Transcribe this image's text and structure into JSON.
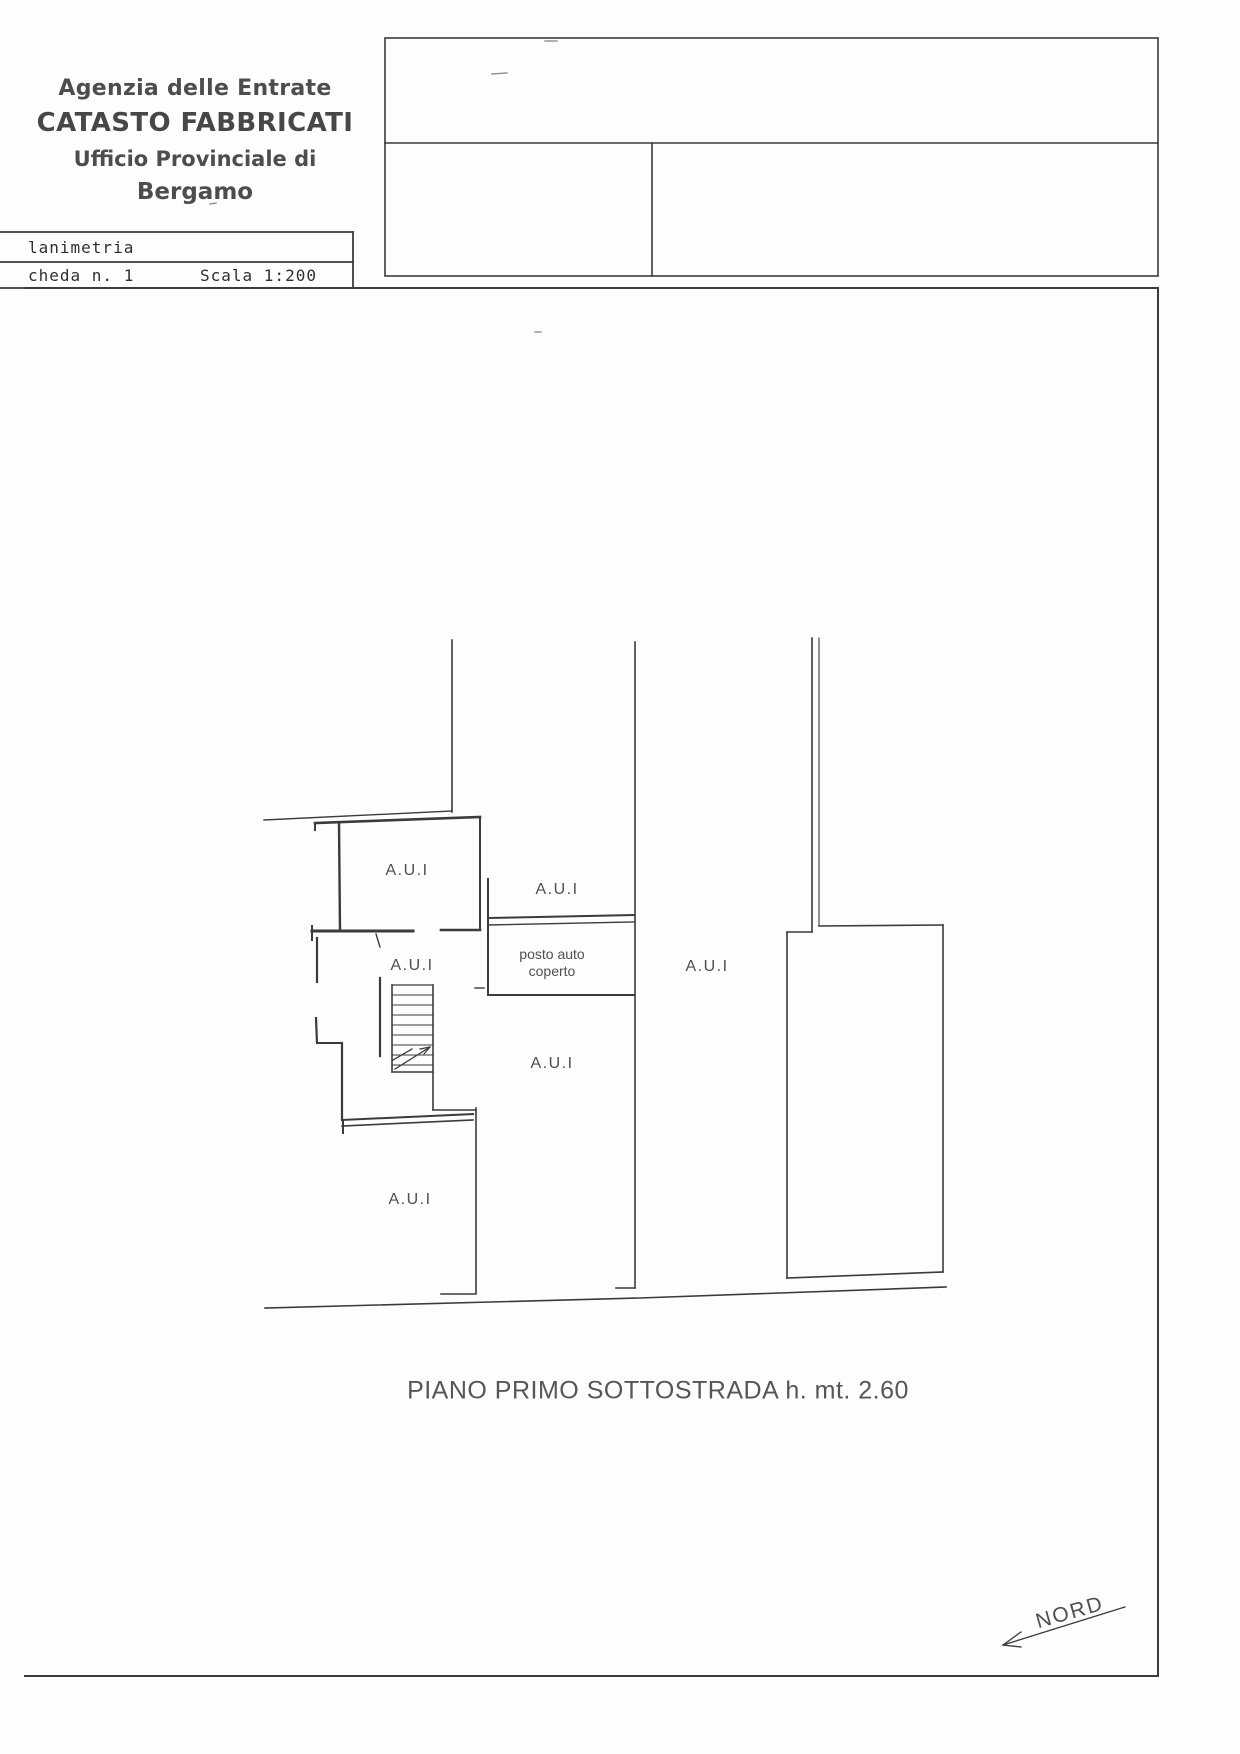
{
  "header": {
    "agency": "Agenzia delle Entrate",
    "registry": "CATASTO FABBRICATI",
    "office_line": "Ufficio Provinciale di",
    "city": "Bergamo"
  },
  "info_table": {
    "row1_label": "lanimetria",
    "row2_left": "cheda n. 1",
    "row2_right": "Scala 1:200"
  },
  "plan": {
    "room_labels": [
      "A.U.I",
      "A.U.I",
      "A.U.I",
      "A.U.I",
      "A.U.I",
      "A.U.I"
    ],
    "parking_label_line1": "posto auto",
    "parking_label_line2": "coperto",
    "caption": "PIANO PRIMO SOTTOSTRADA h. mt. 2.60",
    "north_label": "NORD"
  },
  "colors": {
    "line": "#3b3b3b",
    "faint_line": "#9a9a9a"
  }
}
